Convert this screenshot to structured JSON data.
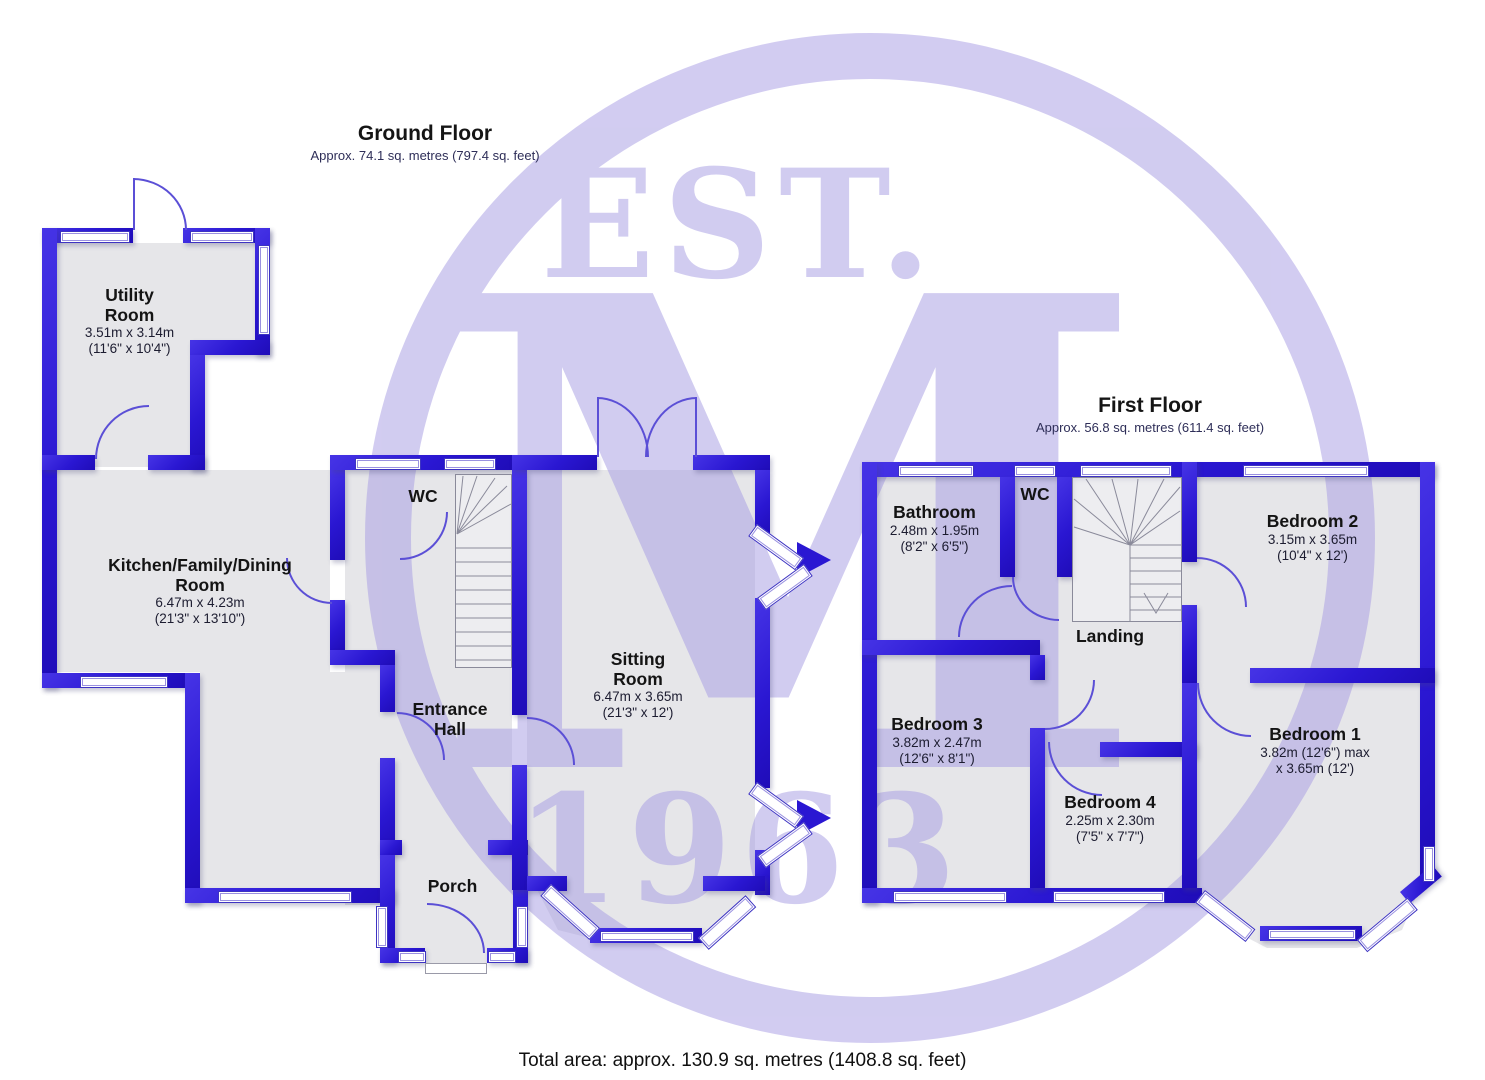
{
  "watermark": {
    "est": "EST.",
    "monogram": "M",
    "year": "1963"
  },
  "ground_floor": {
    "title": "Ground Floor",
    "area": "Approx. 74.1 sq. metres (797.4 sq. feet)",
    "rooms": {
      "utility": {
        "name1": "Utility",
        "name2": "Room",
        "dim1": "3.51m x 3.14m",
        "dim2": "(11'6\" x 10'4\")"
      },
      "kitchen": {
        "name1": "Kitchen/Family/Dining",
        "name2": "Room",
        "dim1": "6.47m x 4.23m",
        "dim2": "(21'3\" x 13'10\")"
      },
      "wc": {
        "name1": "WC"
      },
      "entrance": {
        "name1": "Entrance",
        "name2": "Hall"
      },
      "sitting": {
        "name1": "Sitting",
        "name2": "Room",
        "dim1": "6.47m x 3.65m",
        "dim2": "(21'3\" x 12')"
      },
      "porch": {
        "name1": "Porch"
      }
    }
  },
  "first_floor": {
    "title": "First Floor",
    "area": "Approx. 56.8 sq. metres (611.4 sq. feet)",
    "rooms": {
      "bathroom": {
        "name1": "Bathroom",
        "dim1": "2.48m x 1.95m",
        "dim2": "(8'2\" x 6'5\")"
      },
      "wc": {
        "name1": "WC"
      },
      "bedroom2": {
        "name1": "Bedroom 2",
        "dim1": "3.15m x 3.65m",
        "dim2": "(10'4\" x 12')"
      },
      "landing": {
        "name1": "Landing"
      },
      "bedroom3": {
        "name1": "Bedroom 3",
        "dim1": "3.82m x 2.47m",
        "dim2": "(12'6\" x 8'1\")"
      },
      "bedroom4": {
        "name1": "Bedroom 4",
        "dim1": "2.25m x 2.30m",
        "dim2": "(7'5\" x 7'7\")"
      },
      "bedroom1": {
        "name1": "Bedroom 1",
        "dim1": "3.82m (12'6\") max",
        "dim2": "x 3.65m (12')"
      }
    }
  },
  "footer": {
    "total": "Total area: approx. 130.9 sq. metres (1408.8 sq. feet)"
  }
}
